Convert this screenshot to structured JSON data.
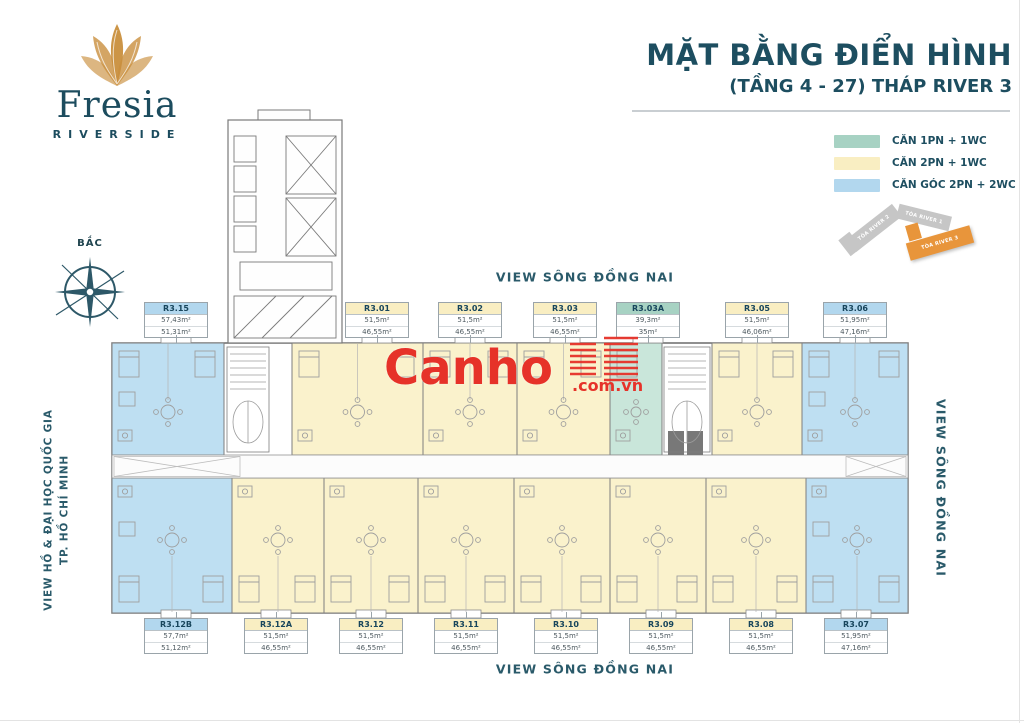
{
  "logo": {
    "name": "Fresia",
    "tagline": "RIVERSIDE"
  },
  "title": {
    "main": "MẶT BẰNG ĐIỂN HÌNH",
    "sub": "(TẦNG 4 - 27) THÁP RIVER 3"
  },
  "legend": {
    "items": [
      {
        "label": "CĂN 1PN + 1WC",
        "color": "#a7d2c3",
        "unit_fill": "#c9e6da"
      },
      {
        "label": "CĂN 2PN + 1WC",
        "color": "#f9eec2",
        "unit_fill": "#faf2cc"
      },
      {
        "label": "CĂN GÓC 2PN + 2WC",
        "color": "#b2d7ee",
        "unit_fill": "#bedff2"
      }
    ]
  },
  "site_map": {
    "buildings": [
      {
        "label": "TÒA RIVER 2",
        "highlight": false
      },
      {
        "label": "TÒA RIVER 1",
        "highlight": false
      },
      {
        "label": "TÒA RIVER 3",
        "highlight": true
      }
    ],
    "highlight_color": "#e8953b",
    "muted_color": "#c6c6c6"
  },
  "compass": {
    "label": "BẮC"
  },
  "views": {
    "top": "VIEW SÔNG ĐỒNG NAI",
    "bottom": "VIEW SÔNG ĐỒNG NAI",
    "right": "VIEW SÔNG ĐỒNG NAI",
    "left_line1": "VIEW HỒ & ĐẠI HỌC QUỐC GIA",
    "left_line2": "TP. HỒ CHÍ MINH"
  },
  "watermark": {
    "text": "Canho",
    "suffix": ".com.vn",
    "color": "#e63229"
  },
  "units": {
    "top": [
      {
        "id": "R3.15",
        "type": "corner",
        "area_top": "57,43m²",
        "area_bottom": "51,31m²"
      },
      {
        "id": "R3.01",
        "type": "standard",
        "area_top": "51,5m²",
        "area_bottom": "46,55m²"
      },
      {
        "id": "R3.02",
        "type": "standard",
        "area_top": "51,5m²",
        "area_bottom": "46,55m²"
      },
      {
        "id": "R3.03",
        "type": "standard",
        "area_top": "51,5m²",
        "area_bottom": "46,55m²"
      },
      {
        "id": "R3.03A",
        "type": "one_bed",
        "area_top": "39,3m²",
        "area_bottom": "35m²"
      },
      {
        "id": "R3.05",
        "type": "standard",
        "area_top": "51,5m²",
        "area_bottom": "46,06m²"
      },
      {
        "id": "R3.06",
        "type": "corner",
        "area_top": "51,95m²",
        "area_bottom": "47,16m²"
      }
    ],
    "bottom": [
      {
        "id": "R3.12B",
        "type": "corner",
        "area_top": "57,7m²",
        "area_bottom": "51,12m²"
      },
      {
        "id": "R3.12A",
        "type": "standard",
        "area_top": "51,5m²",
        "area_bottom": "46,55m²"
      },
      {
        "id": "R3.12",
        "type": "standard",
        "area_top": "51,5m²",
        "area_bottom": "46,55m²"
      },
      {
        "id": "R3.11",
        "type": "standard",
        "area_top": "51,5m²",
        "area_bottom": "46,55m²"
      },
      {
        "id": "R3.10",
        "type": "standard",
        "area_top": "51,5m²",
        "area_bottom": "46,55m²"
      },
      {
        "id": "R3.09",
        "type": "standard",
        "area_top": "51,5m²",
        "area_bottom": "46,55m²"
      },
      {
        "id": "R3.08",
        "type": "standard",
        "area_top": "51,5m²",
        "area_bottom": "46,55m²"
      },
      {
        "id": "R3.07",
        "type": "corner",
        "area_top": "51,95m²",
        "area_bottom": "47,16m²"
      }
    ]
  }
}
